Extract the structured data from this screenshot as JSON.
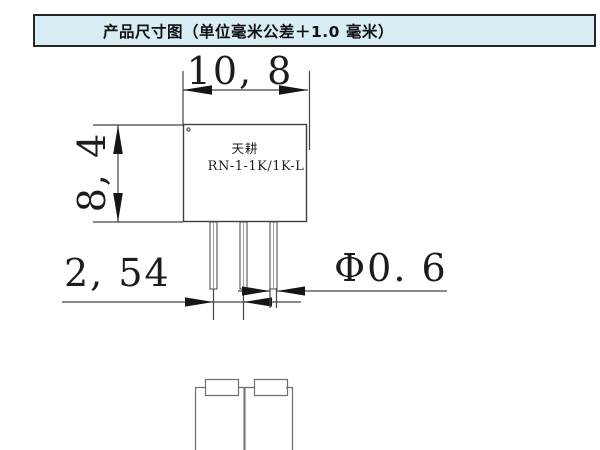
{
  "header": {
    "title": "产品尺寸图（单位毫米公差＋1.0 毫米）"
  },
  "drawing": {
    "component": {
      "brand": "天耕",
      "model": "RN-1-1K/1K-L"
    },
    "dimensions": {
      "width": "10, 8",
      "height": "8, 4",
      "pin_pitch": "2, 54",
      "pin_diameter": "Φ0. 6"
    }
  },
  "colors": {
    "header_bg": "#d9edf5",
    "header_border": "#262626",
    "line": "#454545",
    "arrow": "#161616",
    "schematic_line": "#6f6f6f"
  }
}
